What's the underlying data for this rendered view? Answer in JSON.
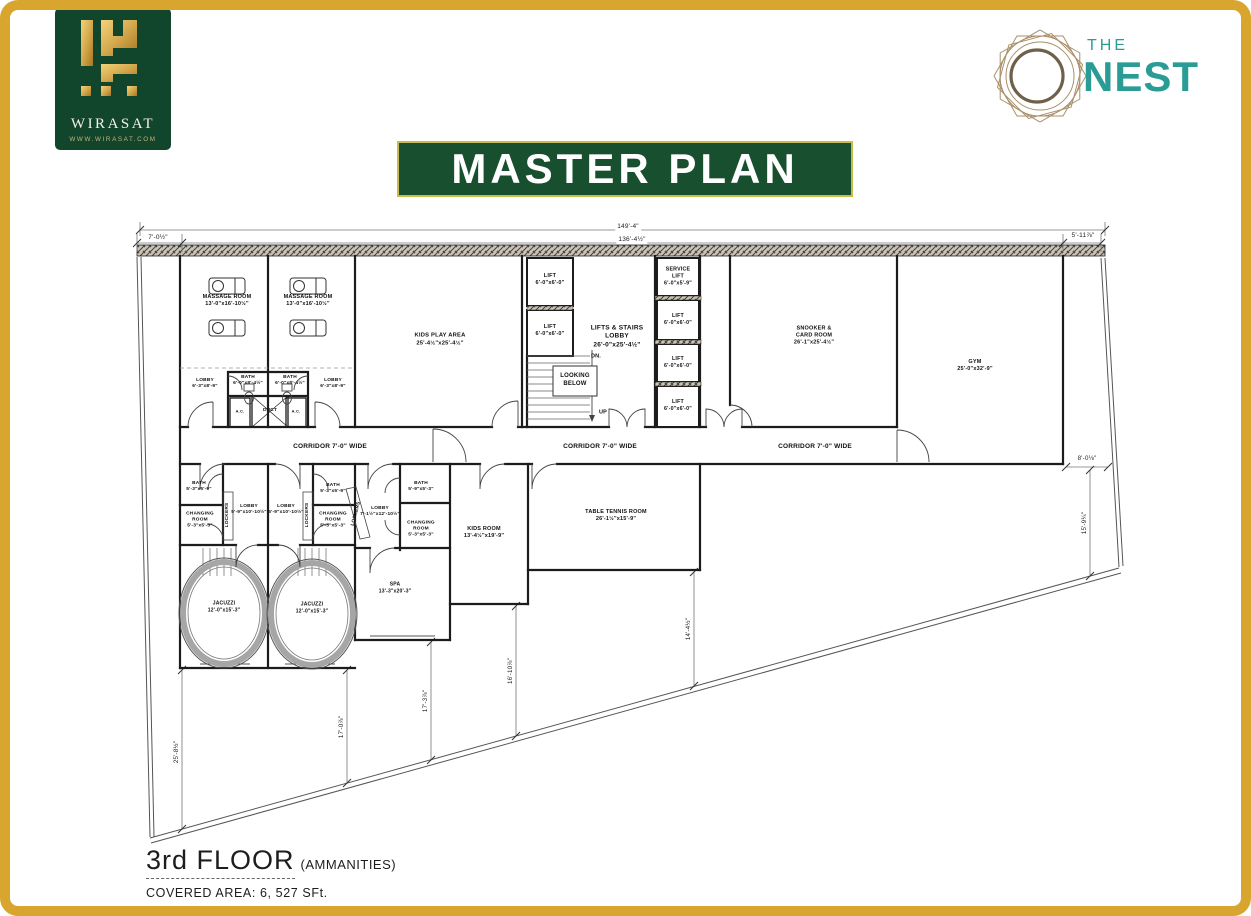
{
  "colors": {
    "gold_frame": "#D8A62E",
    "brand_green": "#174F2F",
    "banner_border": "#C9BC4E",
    "teal": "#2B9C95",
    "nest_ring": "#A8906B",
    "logo_green": "#11462D",
    "logo_gold": "#D4A94E",
    "plan_line": "#1C1C1C"
  },
  "header": {
    "wirasat": {
      "name": "WIRASAT",
      "website": "WWW.WIRASAT.COM"
    },
    "nest": {
      "word_the": "THE",
      "word_nest": "NEST"
    },
    "title": "MASTER PLAN"
  },
  "footer": {
    "floor": "3rd FLOOR",
    "floor_note": "(AMMANITIES)",
    "covered_area": "COVERED AREA: 6, 527 SFt."
  },
  "plan": {
    "labels": [
      {
        "n": "massage-room-1-label",
        "t": "MASSAGE ROOM\n13'-0\"x16'-10½\"",
        "x": 227,
        "y": 301,
        "fs": 5.5,
        "b": 1
      },
      {
        "n": "massage-room-2-label",
        "t": "MASSAGE ROOM\n13'-0\"x16'-10½\"",
        "x": 308,
        "y": 301,
        "fs": 5.5,
        "b": 1
      },
      {
        "n": "kids-play-area-label",
        "t": "KIDS PLAY AREA\n25'-4½\"x25'-4½\"",
        "x": 440,
        "y": 340,
        "fs": 5.8,
        "b": 1
      },
      {
        "n": "lift-a-label",
        "t": "LIFT\n6'-0\"x6'-0\"",
        "x": 550,
        "y": 280,
        "fs": 5.5,
        "b": 1
      },
      {
        "n": "lift-b-label",
        "t": "LIFT\n6'-0\"x6'-0\"",
        "x": 550,
        "y": 331,
        "fs": 5.5,
        "b": 1
      },
      {
        "n": "lifts-stairs-lobby-label",
        "t": "LIFTS & STAIRS\nLOBBY\n26'-0\"x25'-4½\"",
        "x": 617,
        "y": 337,
        "fs": 6.5,
        "b": 1
      },
      {
        "n": "dn-label",
        "t": "DN.",
        "x": 596,
        "y": 357,
        "fs": 5.5,
        "b": 1
      },
      {
        "n": "looking-below-label",
        "t": "LOOKING\nBELOW",
        "x": 575,
        "y": 381,
        "fs": 6,
        "b": 1
      },
      {
        "n": "up-label",
        "t": "UP",
        "x": 603,
        "y": 413,
        "fs": 5.5,
        "b": 1
      },
      {
        "n": "service-lift-label",
        "t": "SERVICE\nLIFT\n6'-0\"x5'-9\"",
        "x": 678,
        "y": 277,
        "fs": 5.3,
        "b": 1
      },
      {
        "n": "lift-1-label",
        "t": "LIFT\n6'-0\"x6'-0\"",
        "x": 678,
        "y": 320,
        "fs": 5.3,
        "b": 1
      },
      {
        "n": "lift-2-label",
        "t": "LIFT\n6'-0\"x6'-0\"",
        "x": 678,
        "y": 363,
        "fs": 5.3,
        "b": 1
      },
      {
        "n": "lift-3-label",
        "t": "LIFT\n6'-0\"x6'-0\"",
        "x": 678,
        "y": 406,
        "fs": 5.3,
        "b": 1
      },
      {
        "n": "snooker-card-room-label",
        "t": "SNOOKER &\nCARD ROOM\n26'-1\"x25'-4½\"",
        "x": 814,
        "y": 336,
        "fs": 5.5,
        "b": 1
      },
      {
        "n": "gym-label",
        "t": "GYM\n25'-0\"x32'-9\"",
        "x": 975,
        "y": 366,
        "fs": 5.5,
        "b": 1
      },
      {
        "n": "lobby-upper-1-label",
        "t": "LOBBY\n6'-3\"x8'-9\"",
        "x": 205,
        "y": 384,
        "fs": 4.8,
        "b": 1
      },
      {
        "n": "bath-upper-1-label",
        "t": "BATH\n6'-0\"x8'-4½\"",
        "x": 248,
        "y": 381,
        "fs": 4.8,
        "b": 1
      },
      {
        "n": "bath-upper-2-label",
        "t": "BATH\n6'-0\"x8'-4½\"",
        "x": 290,
        "y": 381,
        "fs": 4.8,
        "b": 1
      },
      {
        "n": "lobby-upper-2-label",
        "t": "LOBBY\n6'-3\"x8'-9\"",
        "x": 333,
        "y": 384,
        "fs": 4.8,
        "b": 1
      },
      {
        "n": "ac-1-label",
        "t": "A.C.",
        "x": 240,
        "y": 411,
        "fs": 4,
        "b": 1
      },
      {
        "n": "duct-label",
        "t": "DUCT",
        "x": 270,
        "y": 411,
        "fs": 4.8,
        "b": 1
      },
      {
        "n": "ac-2-label",
        "t": "A.C.",
        "x": 296,
        "y": 411,
        "fs": 4,
        "b": 1
      },
      {
        "n": "corridor-1-label",
        "t": "CORRIDOR 7'-0\" WIDE",
        "x": 330,
        "y": 447,
        "fs": 6.5,
        "b": 1
      },
      {
        "n": "corridor-2-label",
        "t": "CORRIDOR 7'-0\" WIDE",
        "x": 600,
        "y": 447,
        "fs": 6.5,
        "b": 1
      },
      {
        "n": "corridor-3-label",
        "t": "CORRIDOR 7'-0\" WIDE",
        "x": 815,
        "y": 447,
        "fs": 6.5,
        "b": 1
      },
      {
        "n": "bath-lower-1-label",
        "t": "BATH\n5'-3\"x5'-9\"",
        "x": 199,
        "y": 487,
        "fs": 4.8,
        "b": 1
      },
      {
        "n": "changing-room-1-label",
        "t": "CHANGING\nROOM\n5'-3\"x5'-3\"",
        "x": 200,
        "y": 521,
        "fs": 4.8,
        "b": 1
      },
      {
        "n": "lockers-1-label",
        "t": "LOCKERS",
        "x": 228,
        "y": 515,
        "fs": 4.8,
        "b": 1,
        "rot": -90
      },
      {
        "n": "lobby-lower-1-label",
        "t": "LOBBY\n5'-9\"x10'-10½\"",
        "x": 249,
        "y": 510,
        "fs": 4.8,
        "b": 1
      },
      {
        "n": "lobby-lower-2-label",
        "t": "LOBBY\n5'-9\"x10'-10½\"",
        "x": 286,
        "y": 510,
        "fs": 4.8,
        "b": 1
      },
      {
        "n": "lockers-2-label",
        "t": "LOCKERS",
        "x": 308,
        "y": 515,
        "fs": 4.8,
        "b": 1,
        "rot": -90
      },
      {
        "n": "bath-lower-2-label",
        "t": "BATH\n5'-3\"x5'-9\"",
        "x": 333,
        "y": 489,
        "fs": 4.8,
        "b": 1
      },
      {
        "n": "changing-room-2-label",
        "t": "CHANGING\nROOM\n5'-3\"x5'-3\"",
        "x": 333,
        "y": 521,
        "fs": 4.8,
        "b": 1
      },
      {
        "n": "lockers-3-label",
        "t": "LOCKERS",
        "x": 357,
        "y": 514,
        "fs": 4.8,
        "b": 1,
        "rot": -75
      },
      {
        "n": "lobby-lower-3-label",
        "t": "LOBBY\n7'-1½\"x12'-10½\"",
        "x": 380,
        "y": 512,
        "fs": 4.8,
        "b": 1
      },
      {
        "n": "bath-lower-3-label",
        "t": "BATH\n5'-9\"x5'-3\"",
        "x": 421,
        "y": 487,
        "fs": 4.8,
        "b": 1
      },
      {
        "n": "changing-room-3-label",
        "t": "CHANGING\nROOM\n5'-3\"x5'-3\"",
        "x": 421,
        "y": 530,
        "fs": 4.8,
        "b": 1
      },
      {
        "n": "jacuzzi-1-label",
        "t": "JACUZZI\n12'-0\"x15'-3\"",
        "x": 224,
        "y": 607,
        "fs": 5,
        "b": 1
      },
      {
        "n": "jacuzzi-2-label",
        "t": "JACUZZI\n12'-0\"x15'-3\"",
        "x": 312,
        "y": 608,
        "fs": 5,
        "b": 1
      },
      {
        "n": "spa-label",
        "t": "SPA\n13'-3\"x20'-3\"",
        "x": 395,
        "y": 588,
        "fs": 5,
        "b": 1
      },
      {
        "n": "kids-room-label",
        "t": "KIDS ROOM\n13'-4½\"x19'-9\"",
        "x": 484,
        "y": 533,
        "fs": 5.5,
        "b": 1
      },
      {
        "n": "table-tennis-room-label",
        "t": "TABLE TENNIS ROOM\n26'-1½\"x15'-9\"",
        "x": 616,
        "y": 516,
        "fs": 5.5,
        "b": 1
      },
      {
        "n": "dim-149-4",
        "t": "149'-4\"",
        "x": 628,
        "y": 227,
        "fs": 6.5,
        "bg": 1
      },
      {
        "n": "dim-136-4",
        "t": "136'-4½\"",
        "x": 632,
        "y": 240,
        "fs": 6.5,
        "bg": 1
      },
      {
        "n": "dim-7-0",
        "t": "7'-0½\"",
        "x": 158,
        "y": 238,
        "fs": 6.5,
        "bg": 1
      },
      {
        "n": "dim-5-11",
        "t": "5'-11⅞\"",
        "x": 1083,
        "y": 236,
        "fs": 6.5,
        "bg": 1
      },
      {
        "n": "dim-8-0",
        "t": "8'-0⅛\"",
        "x": 1087,
        "y": 459,
        "fs": 6.2,
        "bg": 1
      },
      {
        "n": "dim-15-9",
        "t": "15'-9¼\"",
        "x": 1085,
        "y": 523,
        "fs": 6.2,
        "rot": -90
      },
      {
        "n": "dim-25-8",
        "t": "25'-8½\"",
        "x": 177,
        "y": 752,
        "fs": 6.2,
        "rot": -90
      },
      {
        "n": "dim-17-0",
        "t": "17'-0⅞\"",
        "x": 342,
        "y": 727,
        "fs": 6.2,
        "rot": -90
      },
      {
        "n": "dim-17-3",
        "t": "17'-3⅞\"",
        "x": 426,
        "y": 701,
        "fs": 6.2,
        "rot": -90
      },
      {
        "n": "dim-16-10",
        "t": "16'-10⅞\"",
        "x": 511,
        "y": 671,
        "fs": 6.2,
        "rot": -90
      },
      {
        "n": "dim-14-4",
        "t": "14'-4½\"",
        "x": 689,
        "y": 629,
        "fs": 6.2,
        "rot": -90
      }
    ]
  }
}
